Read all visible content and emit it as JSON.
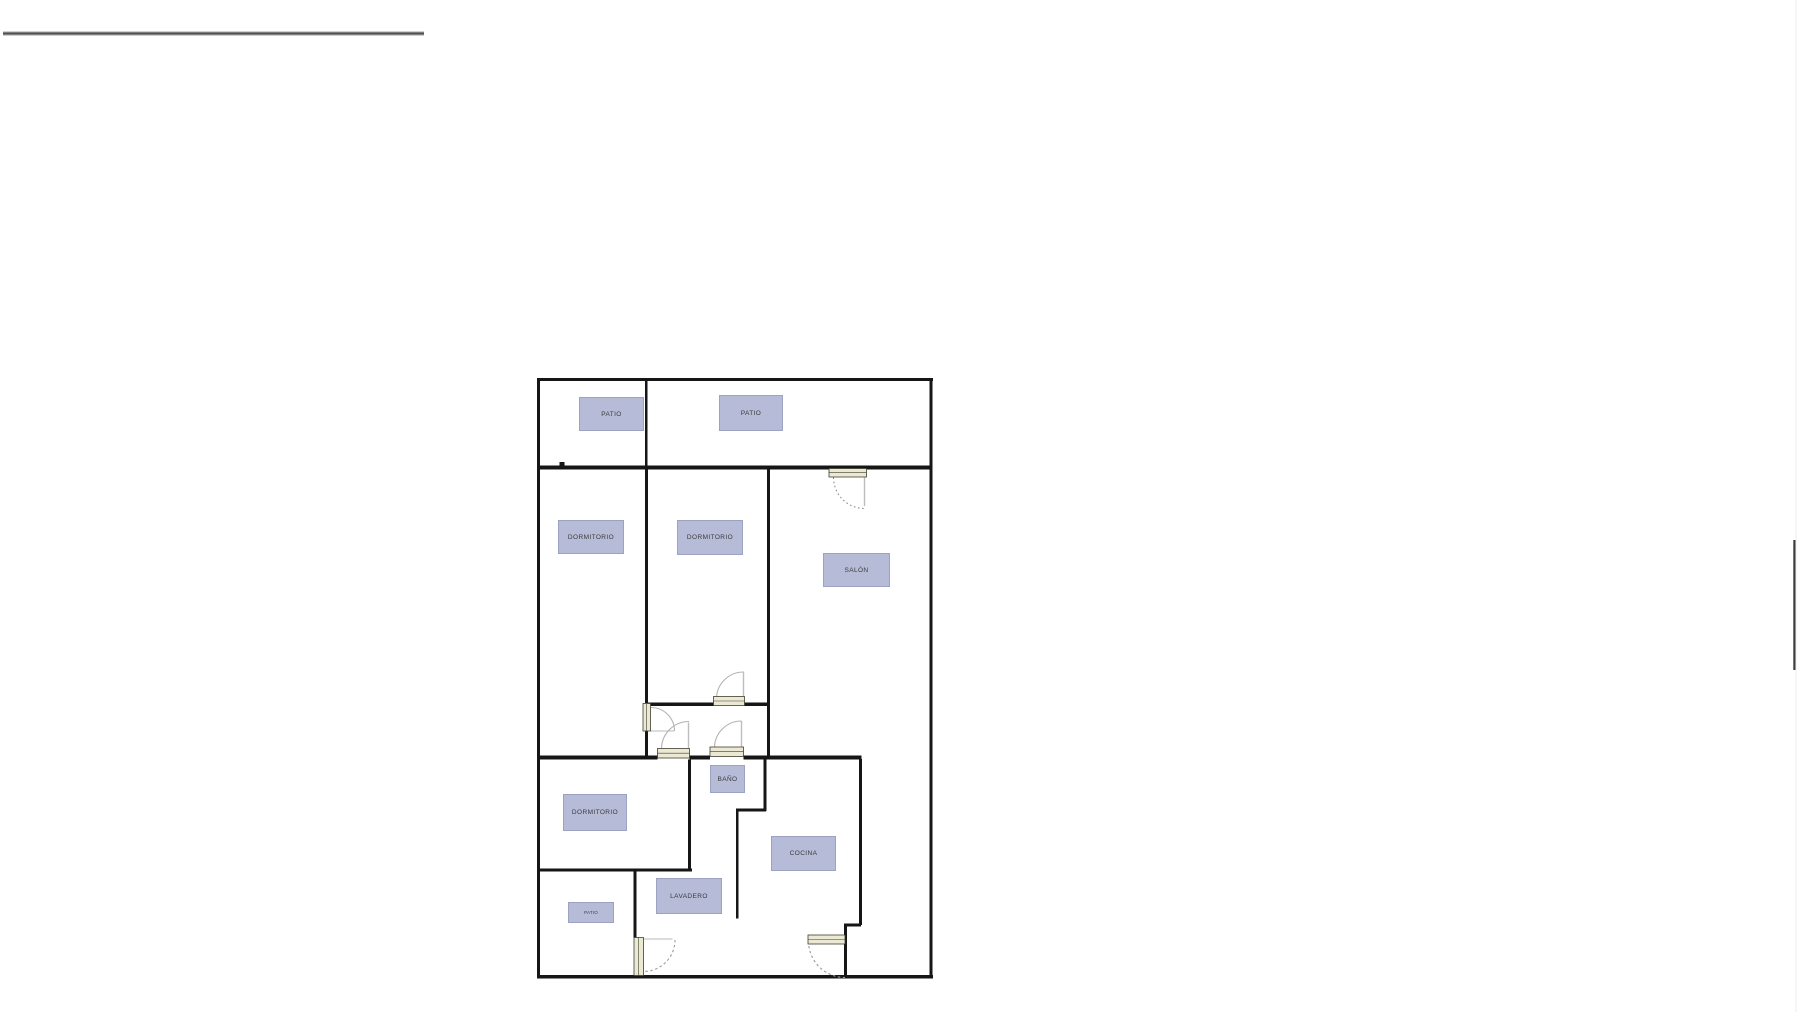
{
  "floor_plan": {
    "rooms": [
      {
        "id": "patio-left",
        "label": "PATIO"
      },
      {
        "id": "patio-right",
        "label": "PATIO"
      },
      {
        "id": "dormitorio-left",
        "label": "DORMITORIO"
      },
      {
        "id": "dormitorio-middle",
        "label": "DORMITORIO"
      },
      {
        "id": "salon",
        "label": "SALÓN"
      },
      {
        "id": "dormitorio-lower",
        "label": "DORMITORIO"
      },
      {
        "id": "bano",
        "label": "BAÑO"
      },
      {
        "id": "cocina",
        "label": "COCINA"
      },
      {
        "id": "lavadero",
        "label": "LAVADERO"
      },
      {
        "id": "patio-small",
        "label": "PATIO"
      }
    ],
    "colors": {
      "wall": "#161616",
      "room_label_background": "#b6bbd7",
      "room_label_text": "#3b3b3b",
      "door_panel_fill": "#ebe8d4",
      "door_panel_border": "#3f3f2e",
      "door_swing_arc": "#b3b3b3",
      "annotation_line": "#4f4f4f"
    }
  }
}
